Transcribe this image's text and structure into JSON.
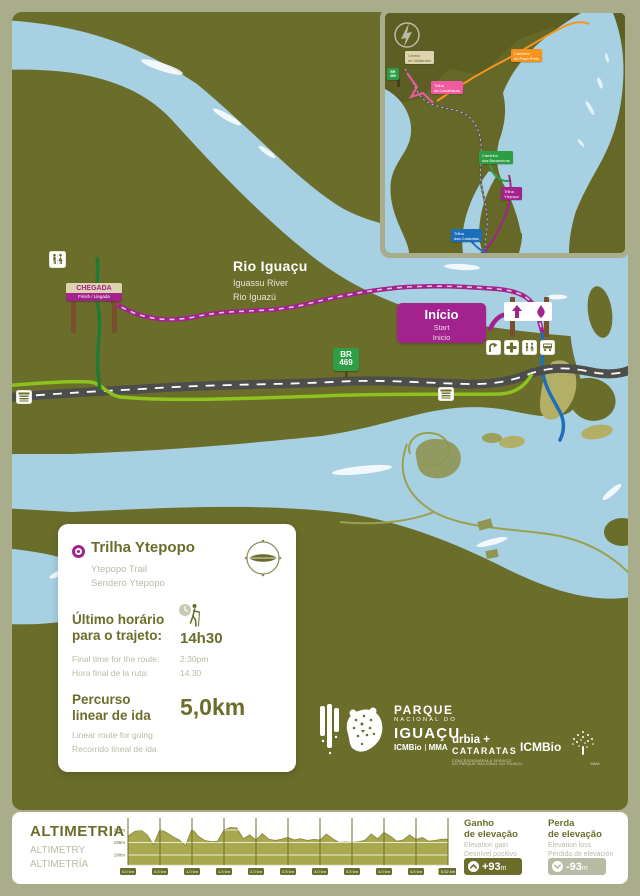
{
  "colors": {
    "olive": "#6b6d2b",
    "sage": "#a9ad8b",
    "water": "#a7d1e2",
    "magenta": "#a2238e",
    "pink": "#ef5ba1",
    "orange": "#f7941d",
    "green": "#2e9e44",
    "blue": "#1d6fba",
    "road_gray": "#4d4d4b",
    "bike_green": "#8dc21f",
    "sign_beige": "#ddd3ae",
    "muted_text": "#b9bca4",
    "chart_fill": "#a8a94e"
  },
  "map": {
    "river": {
      "pt": "Rio Iguaçu",
      "en": "Iguassu River",
      "es": "Rio Iguazú"
    },
    "chegada": {
      "title": "CHEGADA",
      "subtitle": "Finish / Llegada"
    },
    "inicio": {
      "pt": "Início",
      "en": "Start",
      "es": "Inicio"
    },
    "road_sign": {
      "l1": "BR",
      "l2": "469"
    },
    "icons": {
      "restroom": "restroom-icon",
      "first_aid": "first-aid-cross-icon",
      "viewpoint": "curved-arrow-icon",
      "bus_stop": "bus-stop-icon",
      "trailhead_up_arrow": "up-arrow-icon",
      "trailhead_drop": "drop-icon"
    }
  },
  "inset": {
    "labels": {
      "visitor": {
        "l1": "Centro",
        "l2": "de Visitantes"
      },
      "br": {
        "l1": "BR",
        "l2": "469"
      },
      "canafistula": {
        "l1": "Trilha",
        "l2": "da Canafístula"
      },
      "poco_preto": {
        "l1": "Caminho",
        "l2": "do Poço Preto"
      },
      "bananeiras": {
        "l1": "Caminho",
        "l2": "das Bananeiras"
      },
      "ytepopo": {
        "l1": "Trilha",
        "l2": "Ytepopo"
      },
      "cataratas": {
        "l1": "Trilha",
        "l2": "das Cataratas"
      }
    }
  },
  "card": {
    "title": "Trilha Ytepopo",
    "subtitle_en": "Ytepopo Trail",
    "subtitle_es": "Sendero Ytepopo",
    "time_label_pt_1": "Último horário",
    "time_label_pt_2": "para o trajeto:",
    "time_value_pt": "14h30",
    "time_label_en": "Final time for the route:",
    "time_value_en": "2:30pm",
    "time_label_es": "Hora final de la ruta:",
    "time_value_es": "14:30",
    "dist_label_pt_1": "Percurso",
    "dist_label_pt_2": "linear de ida",
    "dist_value": "5,0km",
    "dist_label_en": "Linear route for going",
    "dist_label_es": "Recorrido lineal de ida"
  },
  "logos": {
    "park_1": "PARQUE",
    "park_2": "NACIONAL DO",
    "park_3": "IGUAÇU",
    "park_4a": "ICMBio",
    "park_4b": "MMA",
    "urbia_1": "urbia +",
    "urbia_2": "CATARATAS",
    "urbia_sub1": "CONCESSIONÁRIA A SERVIÇO",
    "urbia_sub2": "DO PARQUE NACIONAL DO IGUAÇU",
    "icmbio": "ICMBio",
    "icmbio_sub": "MMA"
  },
  "altimetry": {
    "title_pt": "ALTIMETRIA",
    "title_en": "ALTIMETRY",
    "title_es": "ALTIMETRÍA",
    "gain_1": "Ganho",
    "gain_2": "de elevação",
    "gain_en": "Elevation gain",
    "gain_es": "Desnível positivo",
    "gain_value": "+93",
    "gain_unit": "m",
    "loss_1": "Perda",
    "loss_2": "de elevação",
    "loss_en": "Elevation loss",
    "loss_es": "Pérdida de elevación",
    "loss_value": "-93",
    "loss_unit": "m"
  },
  "chart_data": {
    "type": "area",
    "title": "ALTIMETRIA",
    "xlabel": "km",
    "ylabel": "m",
    "x_ticks": [
      "0,0 km",
      "0,5 km",
      "1,0 km",
      "1,5 km",
      "2,0 km",
      "2,5 km",
      "3,0 km",
      "3,5 km",
      "4,0 km",
      "4,5 km",
      "5,02 km"
    ],
    "y_ticks": [
      "200m",
      "195m",
      "190m"
    ],
    "y_tick_values": [
      200,
      195,
      190
    ],
    "ylim": [
      186,
      204
    ],
    "x_km": [
      0,
      0.1,
      0.2,
      0.3,
      0.4,
      0.5,
      0.6,
      0.7,
      0.8,
      0.9,
      1.0,
      1.1,
      1.2,
      1.3,
      1.4,
      1.5,
      1.6,
      1.7,
      1.8,
      1.9,
      2.0,
      2.1,
      2.2,
      2.3,
      2.4,
      2.5,
      2.6,
      2.7,
      2.8,
      2.9,
      3.0,
      3.1,
      3.2,
      3.3,
      3.4,
      3.5,
      3.6,
      3.7,
      3.8,
      3.9,
      4.0,
      4.1,
      4.2,
      4.3,
      4.4,
      4.5,
      4.6,
      4.7,
      4.8,
      4.9,
      5.0
    ],
    "elevation_m": [
      197.5,
      199.3,
      200,
      198,
      194,
      200.3,
      199,
      197.3,
      196,
      193.8,
      200.4,
      197.5,
      195.8,
      195.3,
      195.5,
      200,
      201,
      200.8,
      196.5,
      198,
      196,
      198.5,
      196.3,
      195.8,
      196.3,
      197,
      196,
      196.5,
      195.8,
      196.2,
      196,
      198.3,
      196.5,
      195,
      195.2,
      195,
      195.3,
      195.8,
      198.3,
      196.5,
      199,
      197.5,
      195.5,
      196,
      198,
      196.2,
      197,
      195.5,
      195.8,
      196.3,
      196.3
    ],
    "grid": "vertical olive lines at each 0,5 km; white horizontal lines at 190/195/200 m"
  }
}
